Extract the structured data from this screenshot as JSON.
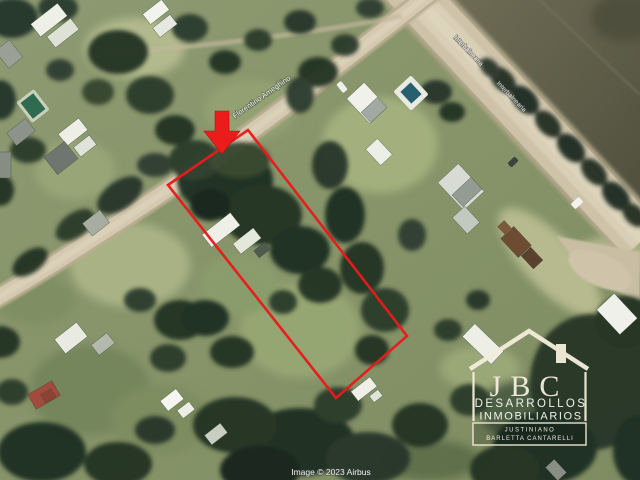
{
  "colors": {
    "annotation_red": "#e81b1b",
    "arrow_red": "#ea1c1c",
    "logo_ivory": "#f3edda",
    "logo_white": "#fafaf2",
    "road_tan": "#d2c7ae"
  },
  "annotations": {
    "plot_outline_points": "168,185 248,130 407,336 336,398",
    "arrow_points": "215,111 229,111 229,131 240,131 222,154 204,131 215,131"
  },
  "street_labels": {
    "main": "Florentino Ameghino",
    "right_upper": "Interbalnearia",
    "right_lower": "Interbalnearia"
  },
  "logo": {
    "initials": "JBC",
    "line1": "DESARROLLOS",
    "line2": "INMOBILIARIOS",
    "footer_line1": "JUSTINIANO",
    "footer_line2": "BARLETTA CANTARELLI"
  },
  "attribution": "Image © 2023 Airbus"
}
